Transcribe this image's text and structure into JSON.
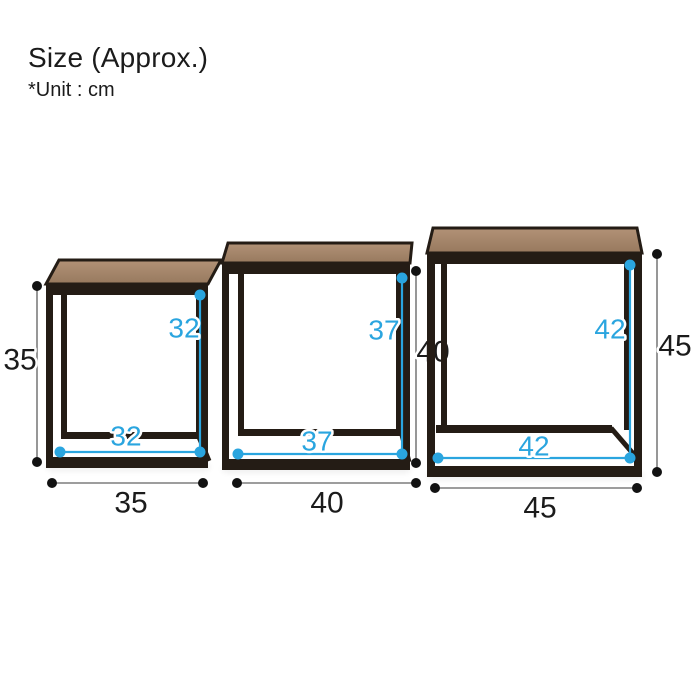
{
  "header": {
    "title": "Size (Approx.)",
    "unit_note": "*Unit : cm"
  },
  "unit": "cm",
  "colors": {
    "accent": "#2aa5df",
    "frame": "#241c15",
    "wood": "#b29277",
    "wood_dark": "#97795e",
    "ink": "#1b1b1b",
    "measure_line": "#7d7d7d",
    "dot": "#121212",
    "background": "#ffffff"
  },
  "tables": [
    {
      "id": "small",
      "outer_width": "35",
      "outer_height": "35",
      "inner_width": "32",
      "inner_height": "32"
    },
    {
      "id": "medium",
      "outer_width": "40",
      "outer_height": "40",
      "inner_width": "37",
      "inner_height": "37"
    },
    {
      "id": "large",
      "outer_width": "45",
      "outer_height": "45",
      "inner_width": "42",
      "inner_height": "42"
    }
  ]
}
